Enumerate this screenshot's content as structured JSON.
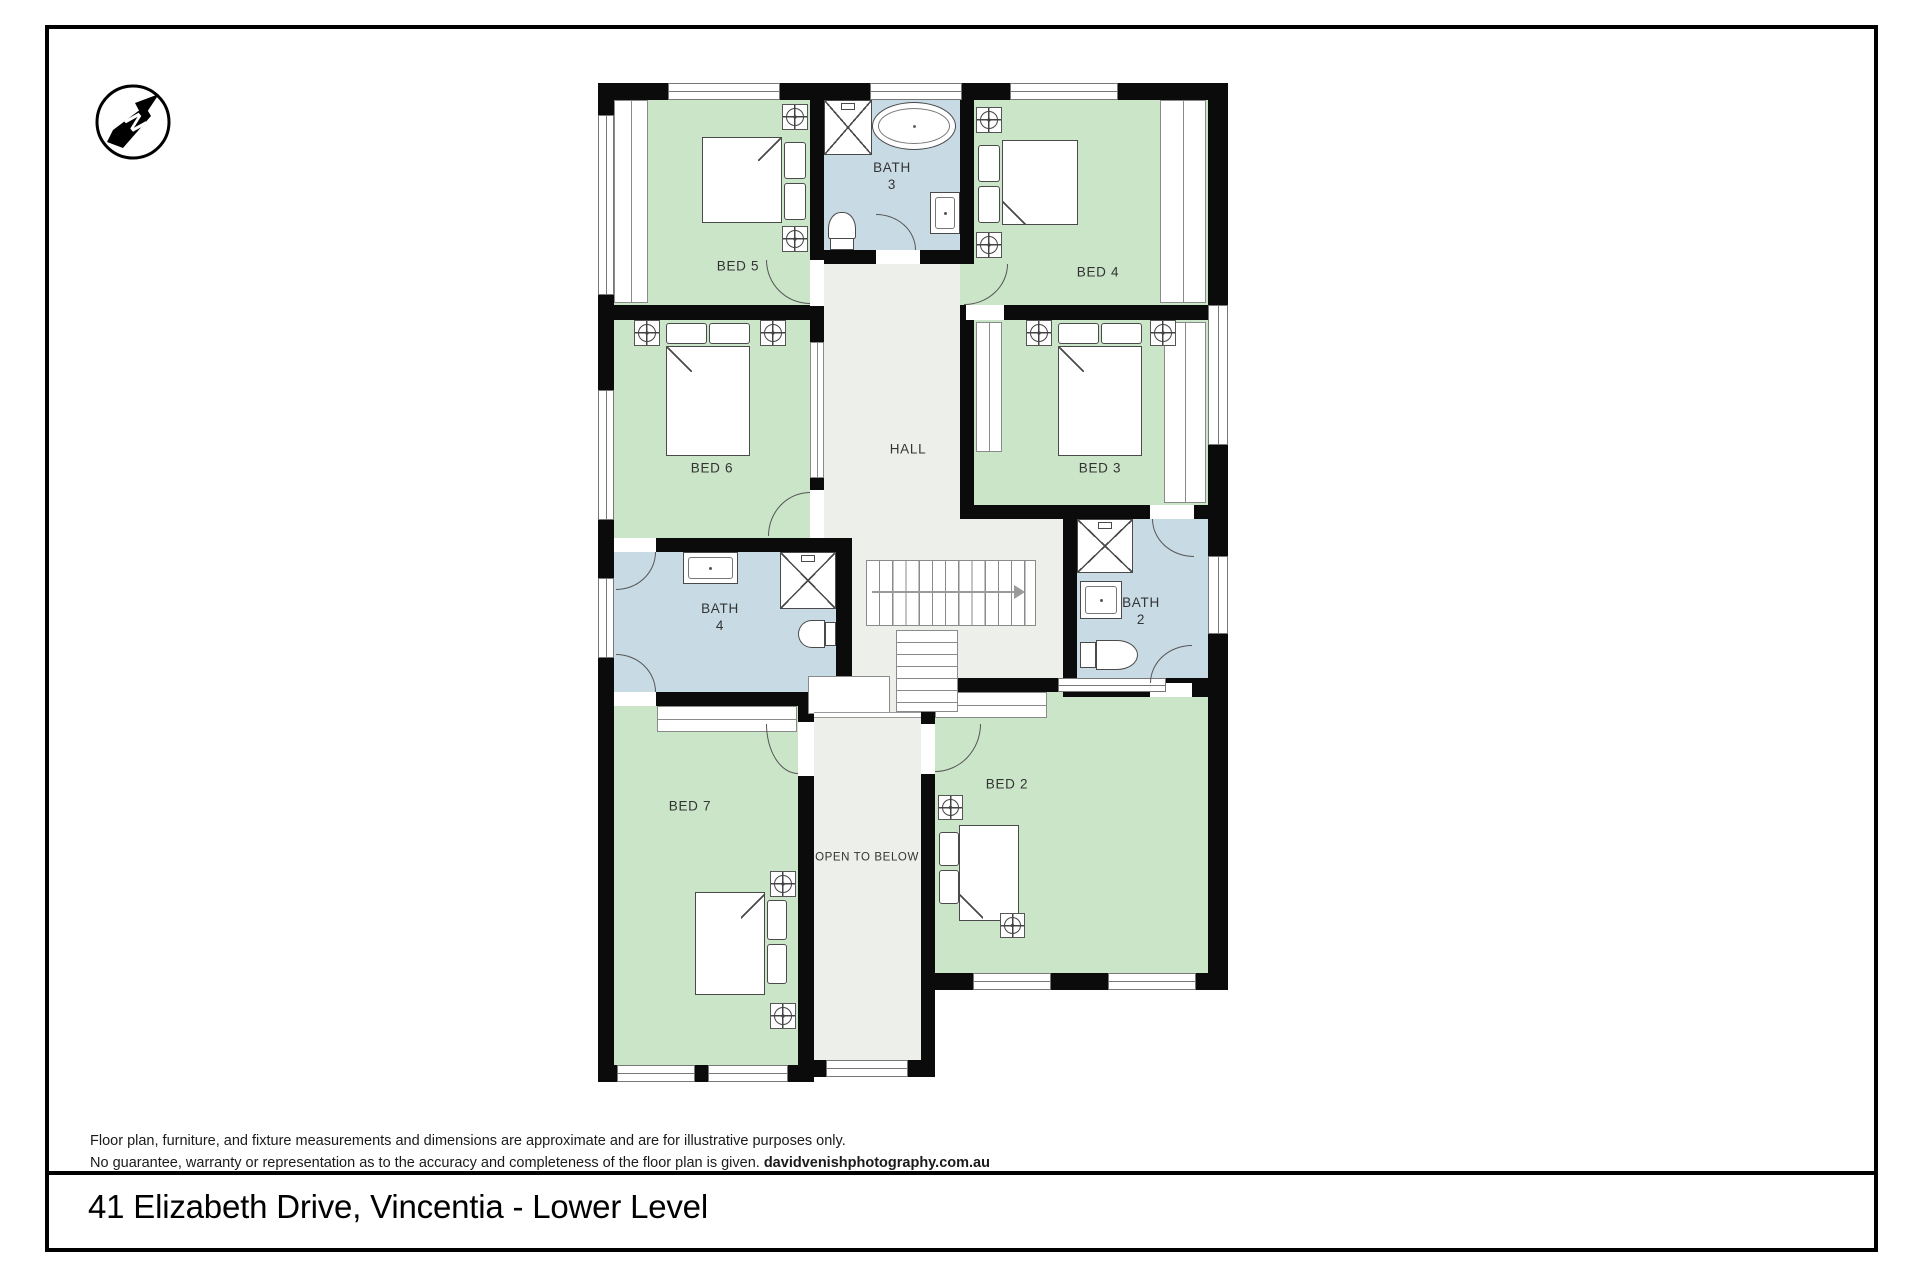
{
  "compass": {
    "letter": "N"
  },
  "plan": {
    "labels": {
      "bed5": "BED 5",
      "bed4": "BED 4",
      "bed6": "BED 6",
      "bed3": "BED 3",
      "bed7": "BED 7",
      "bed2": "BED 2",
      "hall": "HALL",
      "open_to_below": "OPEN TO BELOW",
      "bath3": {
        "line1": "BATH",
        "line2": "3"
      },
      "bath4": {
        "line1": "BATH",
        "line2": "4"
      },
      "bath2": {
        "line1": "BATH",
        "line2": "2"
      }
    },
    "colors": {
      "bedroom": "#cbe5c9",
      "bathroom": "#c8dbe4",
      "hall": "#edf0ea",
      "wall": "#0b0b0b"
    }
  },
  "footer": {
    "disclaimer_line1": "Floor plan, furniture, and fixture measurements and dimensions are approximate and are for illustrative purposes only.",
    "disclaimer_line2": "No guarantee, warranty or representation as to the accuracy and completeness of the floor plan is given.",
    "credit": "davidvenishphotography.com.au",
    "title": "41 Elizabeth Drive, Vincentia - Lower Level"
  }
}
